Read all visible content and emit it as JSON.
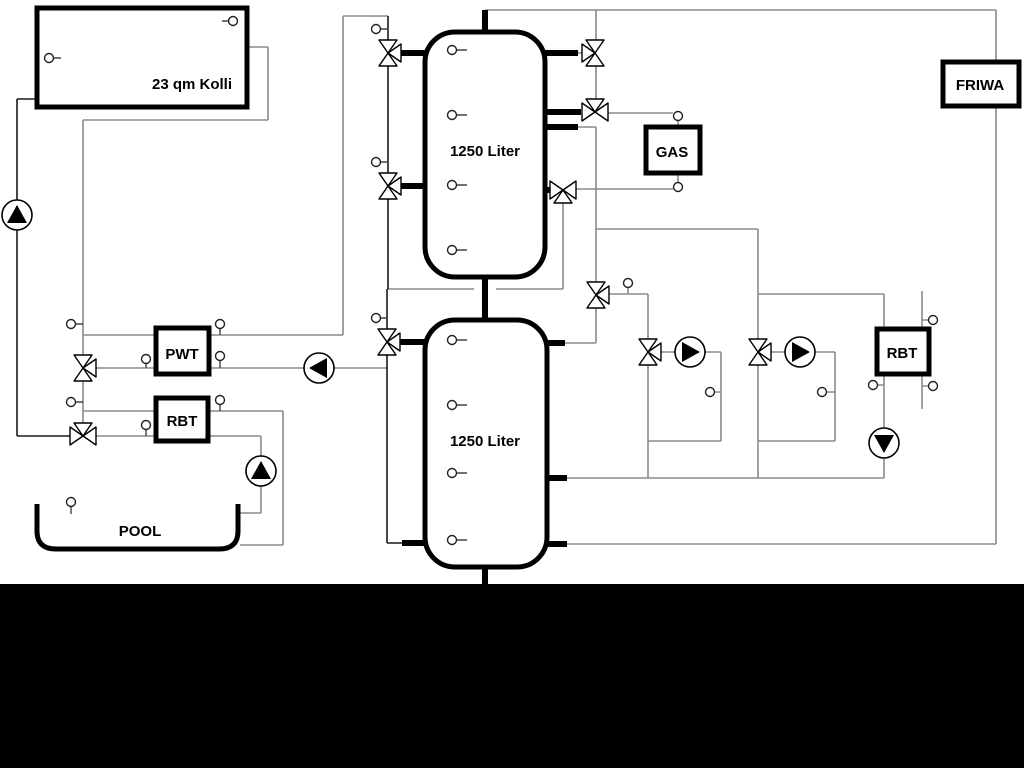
{
  "diagram": {
    "labels": {
      "collector": "23 qm Kolli",
      "buffer_tank_top": "1250 Liter",
      "buffer_tank_bottom": "1250 Liter",
      "gas_boiler": "GAS",
      "friwa": "FRIWA",
      "pwt": "PWT",
      "rbt_left": "RBT",
      "rbt_right": "RBT",
      "pool": "POOL"
    },
    "colors": {
      "background": "#ffffff",
      "pipe": "#8a8a8a",
      "pipe_dark": "#1a1a1a",
      "component": "#000000",
      "footer_band": "#000000"
    }
  }
}
